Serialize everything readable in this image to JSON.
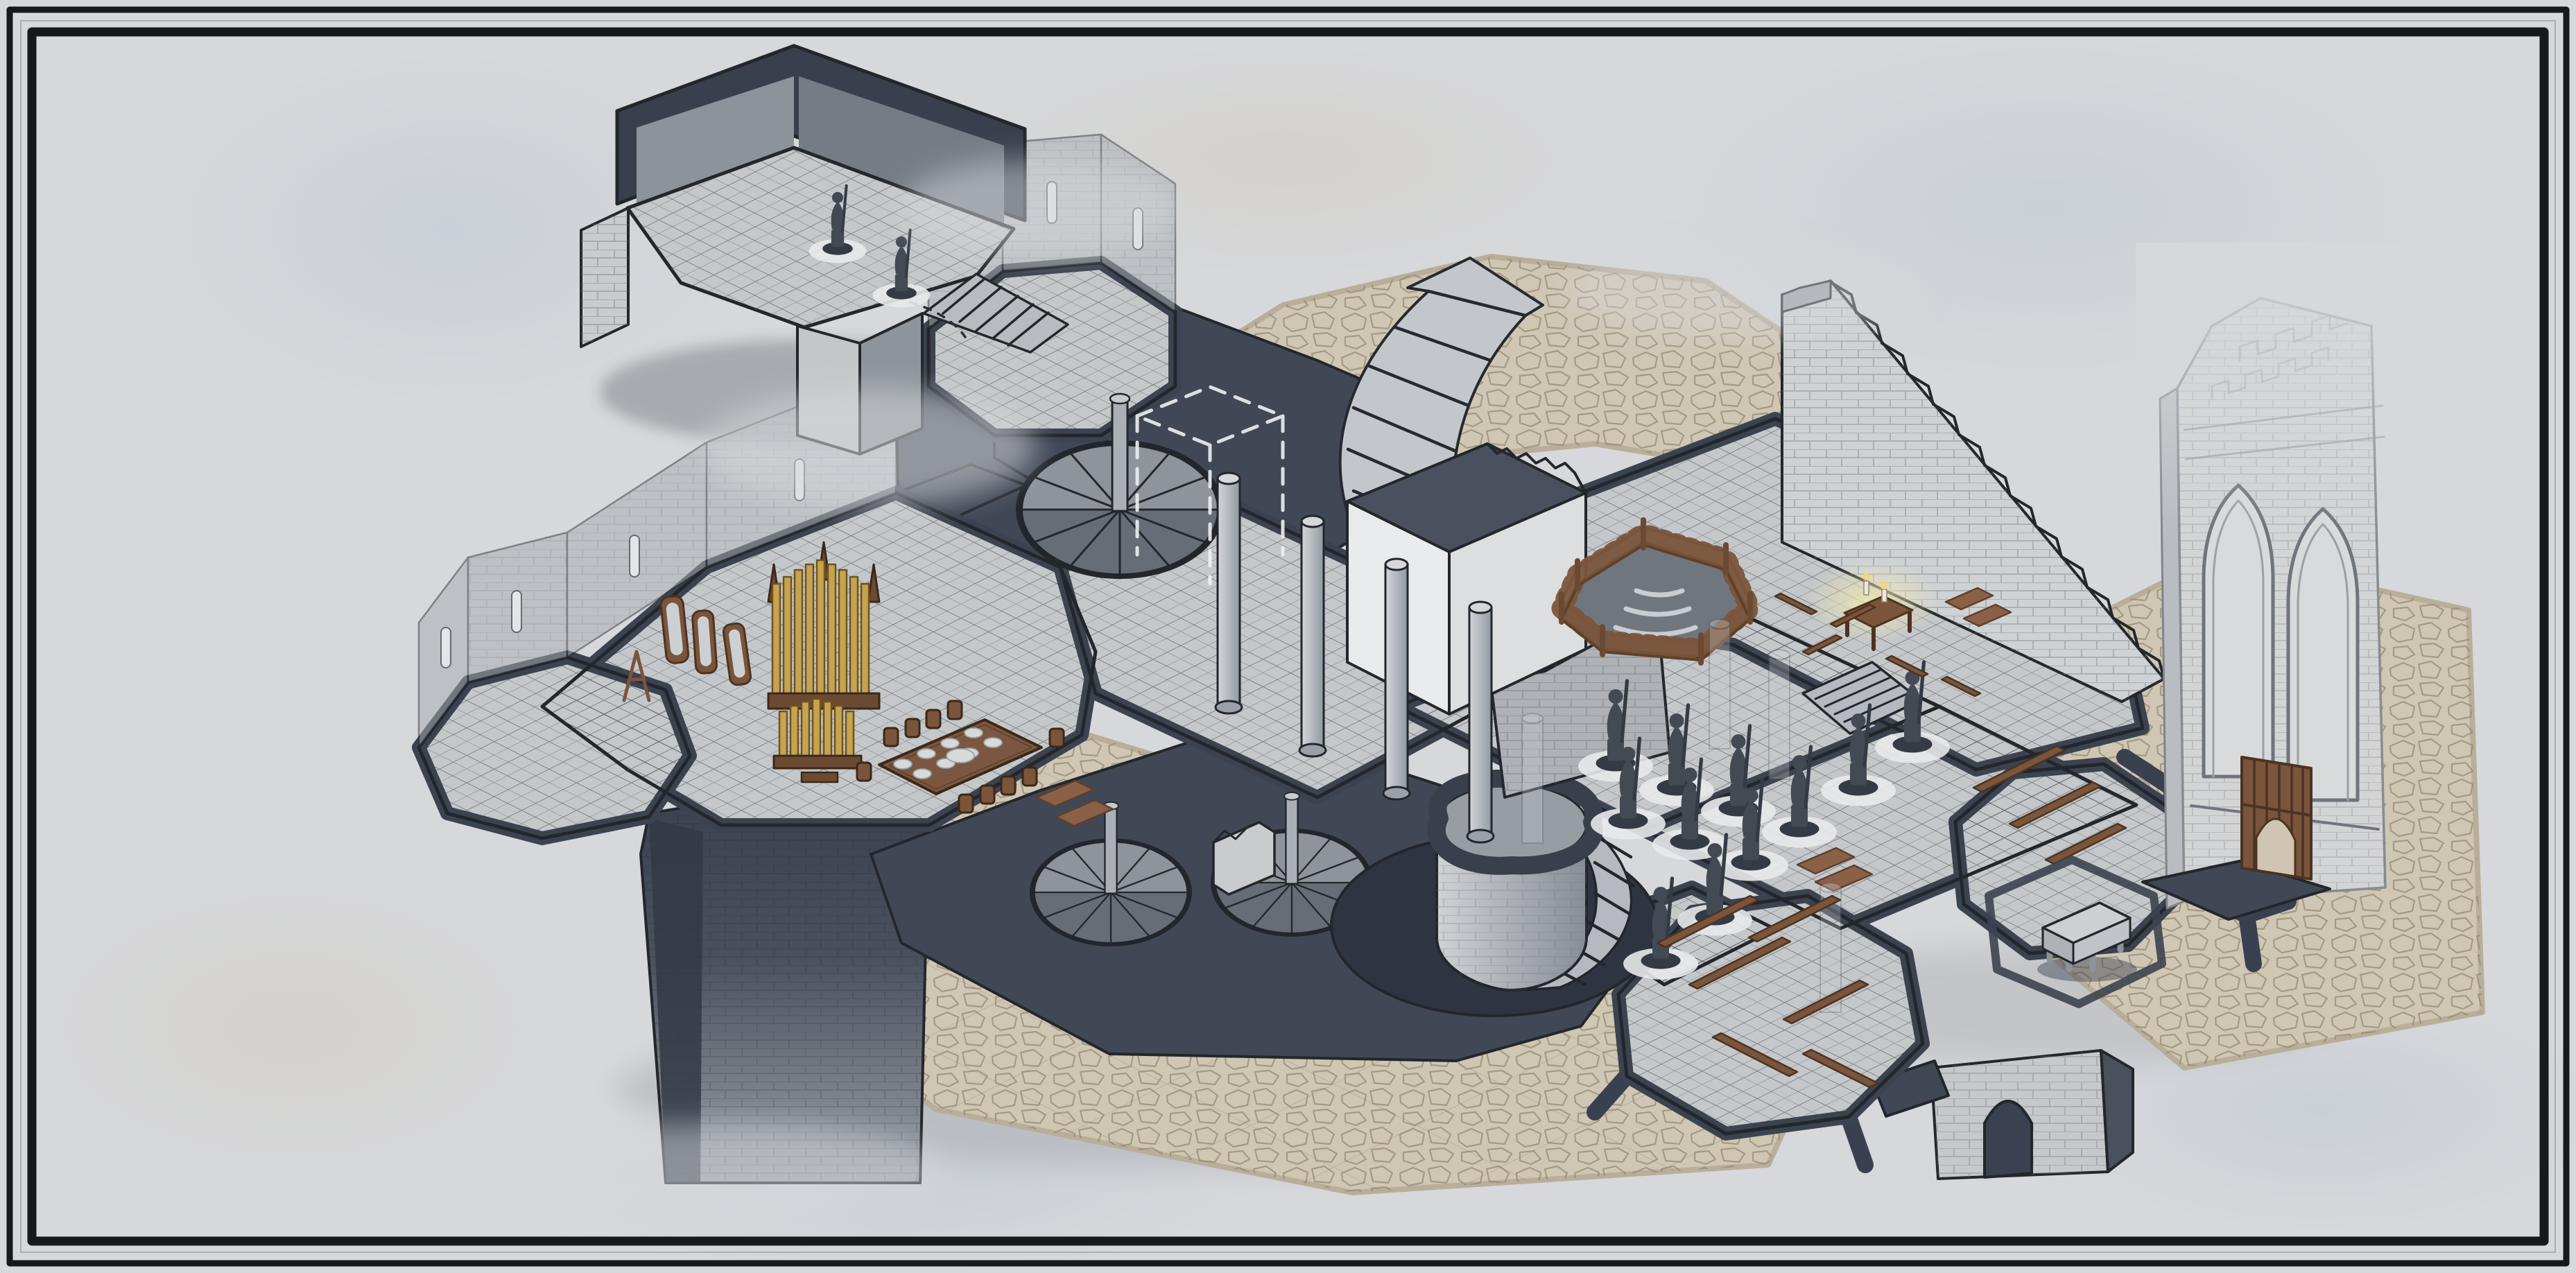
{
  "artwork": {
    "kind": "isometric-fantasy-battle-map",
    "style": "hand-drawn ink with gray watercolor wash",
    "features": {
      "fragment_room": "detached ruined room with two statues and stair",
      "round_tower_room": "octagonal tower room with translucent walls",
      "left_wing": "hall with organ, mirrors and banquet table",
      "organ": "golden pipe organ",
      "mirrors": "standing wood-framed mirrors",
      "banquet_table": "long table with chairs and plates",
      "columns": "stone columns",
      "spiral_stairs": "three spiral staircases with center poles",
      "grand_staircase": "large curved staircase",
      "ghost_outline": "dashed missing-volume outline",
      "fenced_pit": "wood railing around sunken stair",
      "crumbling_wall": "ruined wall with stairs climbing its edge",
      "white_block": "tall pale tower block with crenellated top",
      "desk": "desk with two lit candles",
      "statues": "rows of small statues on round pads",
      "log_platform": "octagonal platform with fallen timbers",
      "sarcophagus_platform": "octagonal platform with stone sarcophagus",
      "arch_foundation": "stone foundation block with arched opening",
      "foundation_cliff": "dark rock foundation mass",
      "ruined_tower": "faded gothic tower with two arched windows and wooden door"
    }
  },
  "palette": {
    "paper": "#d6d8db",
    "frame_ink": "#17191c",
    "ink": "#23262b",
    "dark_plate": "#414855",
    "dark_deep": "#2c313c",
    "tile_floor": "#c5c8ca",
    "cobble_tan": "#cfc7b4",
    "wall_gray": "#a6abb1",
    "white_block": "#e9eaec",
    "wood": "#7a553b",
    "wood_dark": "#4b3322",
    "gold": "#c7a351",
    "statue": "#434a54",
    "glow": "#f3e8ab",
    "wash_blue": "#adbcc8",
    "wash_tan": "#cfc0a6"
  }
}
